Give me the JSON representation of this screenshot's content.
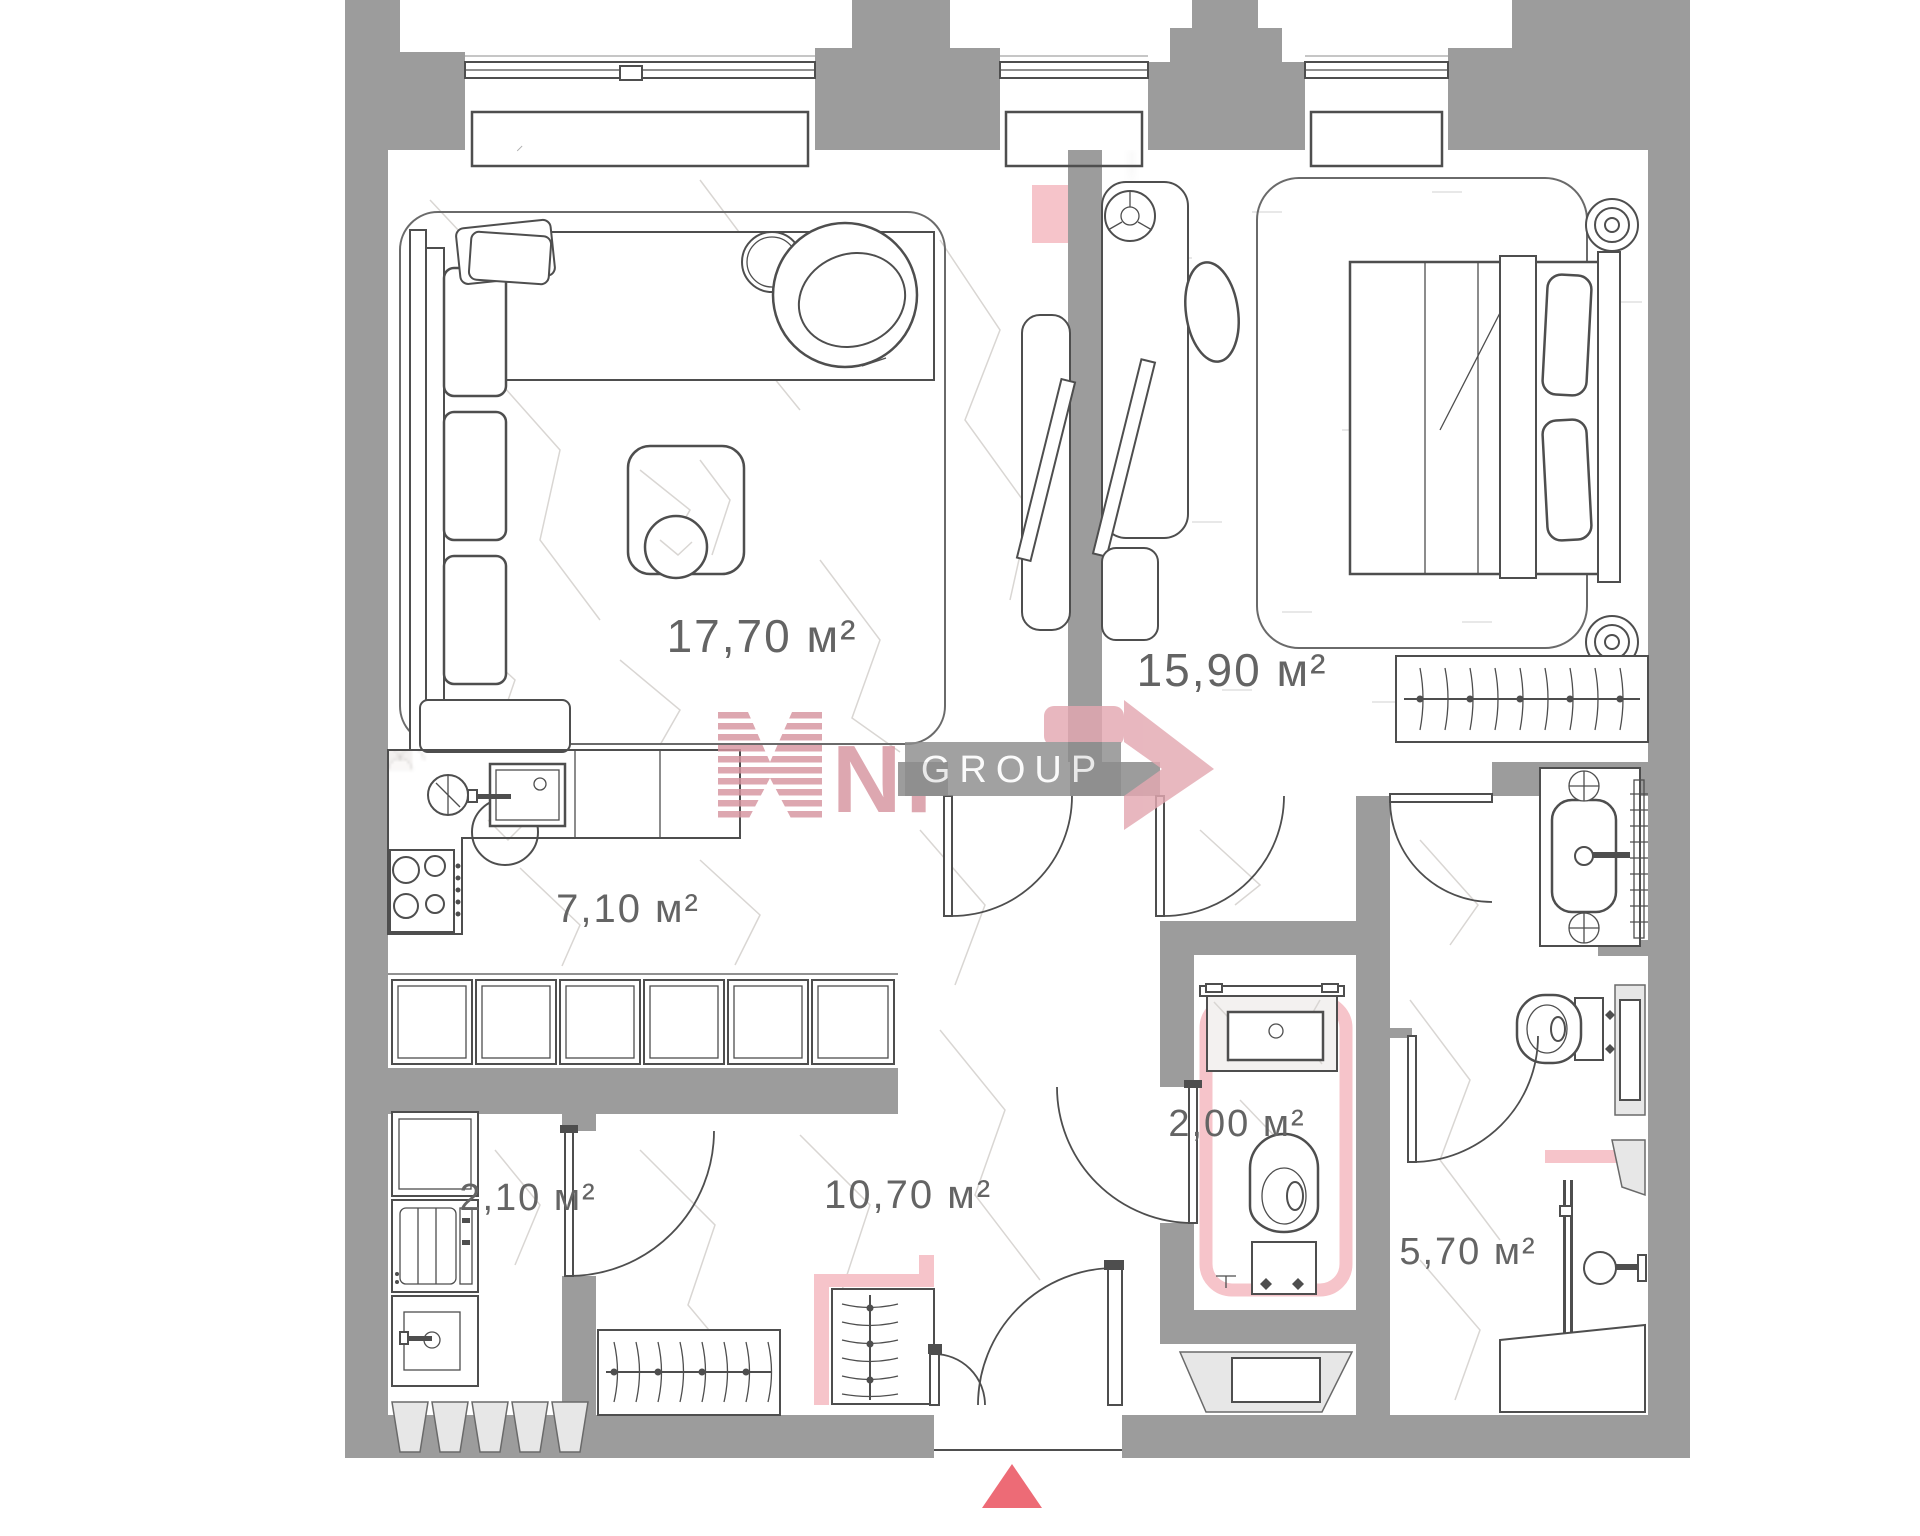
{
  "page": {
    "width": 1920,
    "height": 1536,
    "background": "#ffffff"
  },
  "plan": {
    "type": "apartment-floor-plan",
    "rooms": [
      {
        "key": "living-room",
        "label": "17,70 м²"
      },
      {
        "key": "bedroom",
        "label": "15,90 м²"
      },
      {
        "key": "kitchen",
        "label": "7,10 м²"
      },
      {
        "key": "hallway",
        "label": "10,70 м²"
      },
      {
        "key": "utility",
        "label": "2,10 м²"
      },
      {
        "key": "wc",
        "label": "2,00 м²"
      },
      {
        "key": "bathroom",
        "label": "5,70 м²"
      }
    ],
    "colors": {
      "wall": "#9c9c9c",
      "accent_pink": "#f6c4ca",
      "entrance_red": "#ed6b76",
      "line": "#4e4e4e",
      "label_text": "#646464"
    }
  },
  "watermark": {
    "brand": "NF",
    "group": "GROUP",
    "pink": "#d6949f",
    "box_gray": "#8d8d8d"
  }
}
